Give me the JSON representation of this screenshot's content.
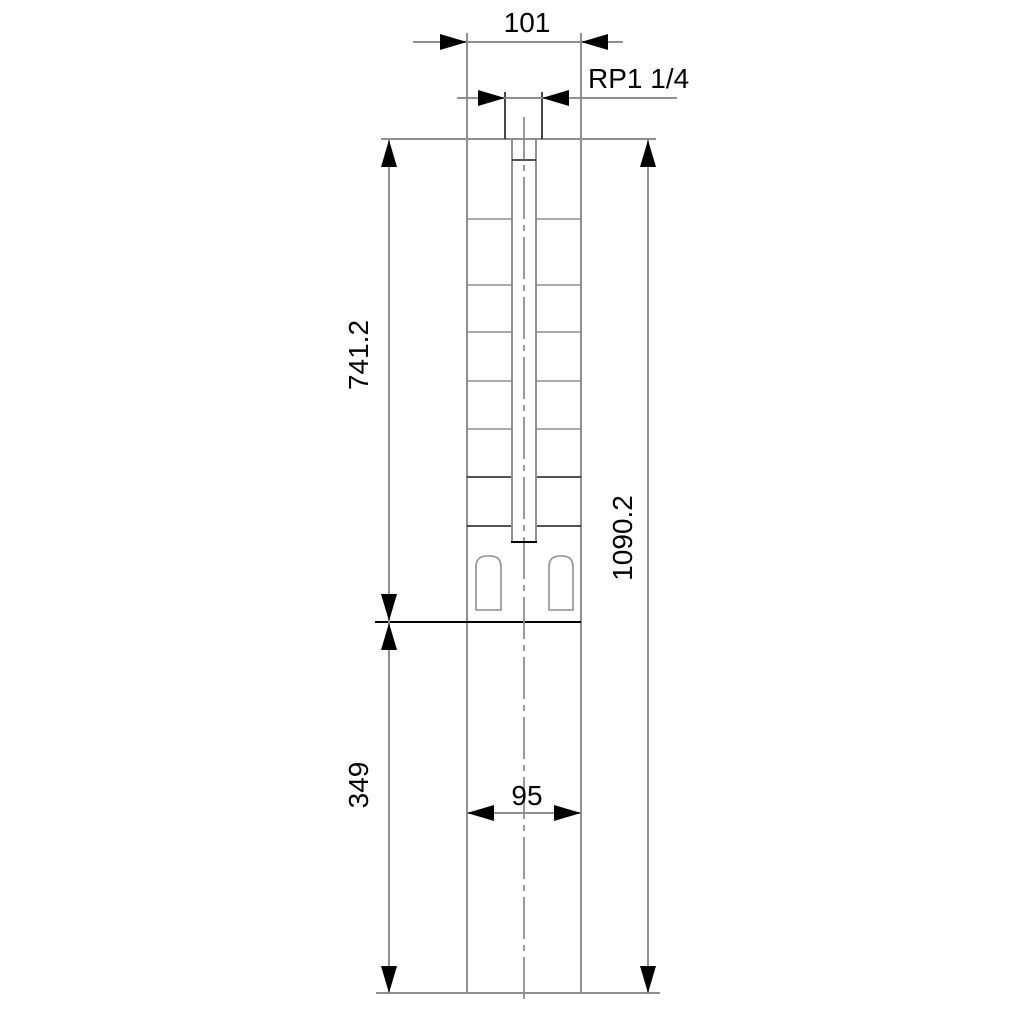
{
  "drawing": {
    "type": "technical-dimension-drawing",
    "subject": "submersible-borehole-pump-outline",
    "dimensions": {
      "top_width": "101",
      "thread": "RP1 1/4",
      "upper_length": "741.2",
      "total_length": "1090.2",
      "lower_length": "349",
      "bottom_width": "95"
    },
    "colors": {
      "background": "#ffffff",
      "line_gray": "#8f8f8f",
      "line_black": "#000000",
      "text": "#000000"
    }
  }
}
